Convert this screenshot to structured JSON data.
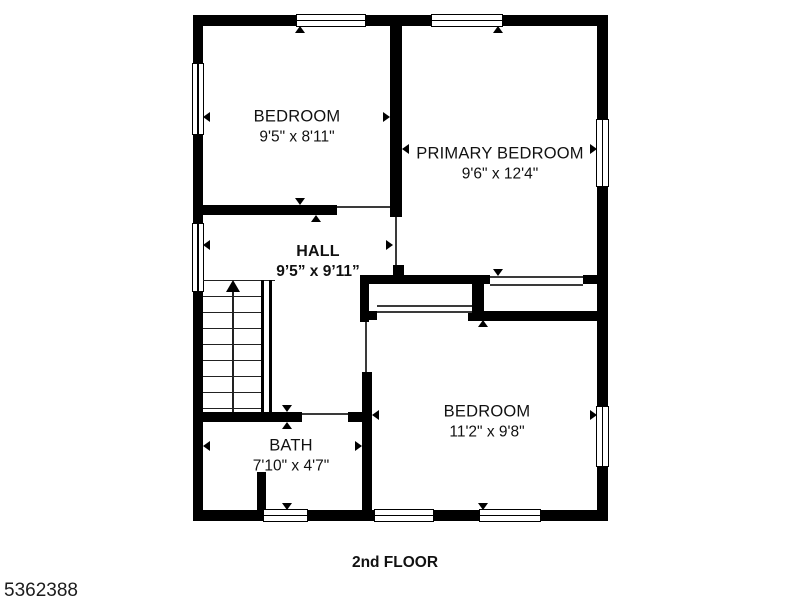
{
  "plan": {
    "rooms": [
      {
        "id": "bedroom-top-left",
        "name": "BEDROOM",
        "dims": "9'5\" x 8'11\""
      },
      {
        "id": "primary-bedroom",
        "name": "PRIMARY BEDROOM",
        "dims": "9'6\" x 12'4\""
      },
      {
        "id": "hall",
        "name": "HALL",
        "dims": "9’5” x 9’11”"
      },
      {
        "id": "bedroom-bottom",
        "name": "BEDROOM",
        "dims": "11'2\" x 9'8\""
      },
      {
        "id": "bath",
        "name": "BATH",
        "dims": "7'10\" x 4'7\""
      }
    ],
    "floor_label": "2nd FLOOR",
    "listing_id": "5362388",
    "colors": {
      "walls": "#000000",
      "background": "#ffffff",
      "text": "#111111"
    },
    "icons": {
      "stairs": "stairs-up-arrow-icon",
      "ticks": "measurement-tick-icon"
    }
  }
}
